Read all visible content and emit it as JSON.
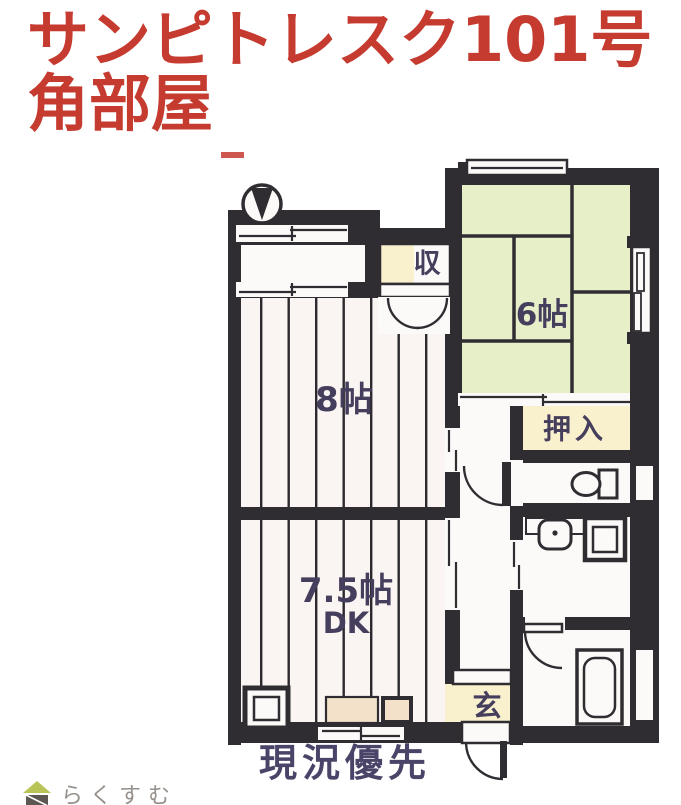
{
  "title": {
    "line1": "サンピトレスク101号",
    "line2": "角部屋"
  },
  "rooms": {
    "living8": {
      "label": "8帖"
    },
    "tatami6": {
      "label": "6帖"
    },
    "dk": {
      "size_label": "7.5帖",
      "type_label": "DK"
    },
    "oshiire": {
      "label": "押入"
    },
    "storage": {
      "label": "収"
    },
    "genkan": {
      "label": "玄"
    }
  },
  "notes": {
    "caveat": "現況優先"
  },
  "branding": {
    "logo_text": "らくすむ"
  },
  "colors": {
    "title_red": "#c63b30",
    "wall": "#302d32",
    "tatami_green": "#e6efc7",
    "accent_yellow": "#f9f1cd",
    "counter_peach": "#f3e2c9",
    "floor_bg": "#faf5f2",
    "floor_line": "#2b282e",
    "label_navy": "#453e5c",
    "note_navy": "#4a4468",
    "logo_green": "#b9c457",
    "logo_gray": "#96908a"
  }
}
